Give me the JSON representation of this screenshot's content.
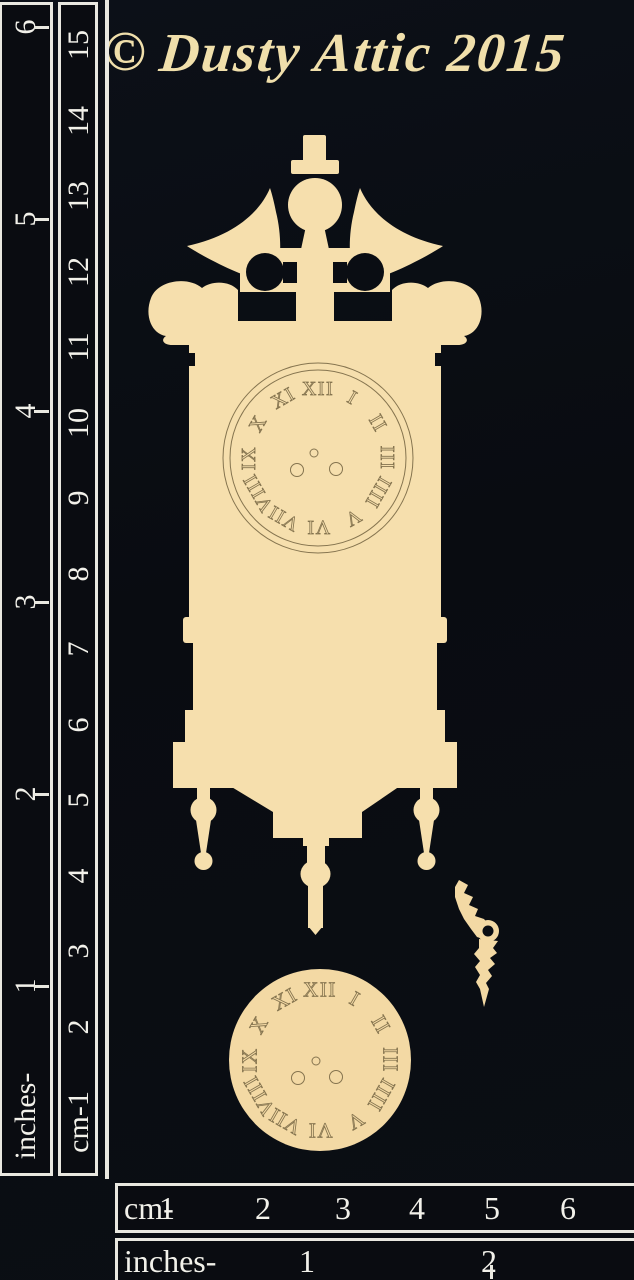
{
  "header": {
    "copyright_symbol": "©",
    "brand": "Dusty Attic 2015"
  },
  "left_ruler": {
    "inches": {
      "unit_label": "inches-",
      "numbers": [
        "6",
        "5",
        "4",
        "3",
        "2",
        "1"
      ]
    },
    "cm": {
      "unit_label": "cm-1",
      "numbers": [
        "15",
        "14",
        "13",
        "12",
        "11",
        "10",
        "9",
        "8",
        "7",
        "6",
        "5",
        "4",
        "3",
        "2"
      ]
    }
  },
  "bottom_ruler": {
    "cm": {
      "unit_label": "cm-",
      "numbers": [
        "1",
        "2",
        "3",
        "4",
        "5",
        "6"
      ]
    },
    "inches": {
      "unit_label": "inches-",
      "numbers": [
        "1",
        "2"
      ]
    }
  },
  "chipboard": {
    "dial_numerals": [
      "XII",
      "I",
      "II",
      "III",
      "IIII",
      "V",
      "VI",
      "VII",
      "VIII",
      "IX",
      "X",
      "XI"
    ],
    "winding_holes_per_dial": 3
  },
  "colors": {
    "background": "#0a0d13",
    "chipboard": "#f6dfad",
    "etch_line": "#85744f",
    "ruler_text": "#f2f1ea",
    "header_text": "#f0dfab"
  }
}
